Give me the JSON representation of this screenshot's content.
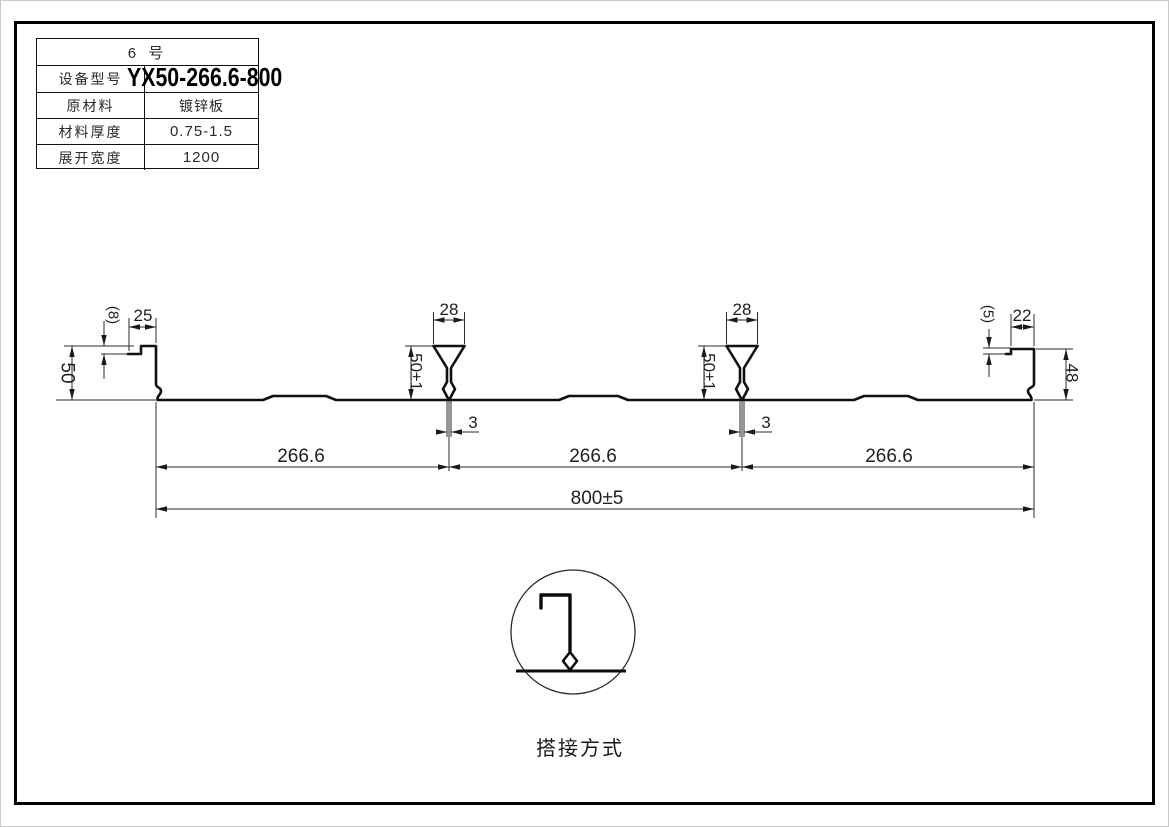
{
  "title_block": {
    "rows": [
      {
        "label": "6  号",
        "value": ""
      },
      {
        "label": "设备型号",
        "value": "YX50-266.6-800"
      },
      {
        "label": "原材料",
        "value": "镀锌板"
      },
      {
        "label": "材料厚度",
        "value": "0.75-1.5"
      },
      {
        "label": "展开宽度",
        "value": "1200"
      }
    ]
  },
  "profile": {
    "dim_left_lip": "25",
    "dim_left_step": "(8)",
    "dim_left_height": "50",
    "dim_rib_width": "28",
    "dim_rib_height": "50±1",
    "dim_rib_stem": "3",
    "dim_span": "266.6",
    "dim_overall": "800±5",
    "dim_right_lip": "22",
    "dim_right_step": "(5)",
    "dim_right_height": "48"
  },
  "detail": {
    "caption": "搭接方式"
  },
  "colors": {
    "line": "#111111",
    "text": "#1f1f1f",
    "background": "#ffffff"
  }
}
